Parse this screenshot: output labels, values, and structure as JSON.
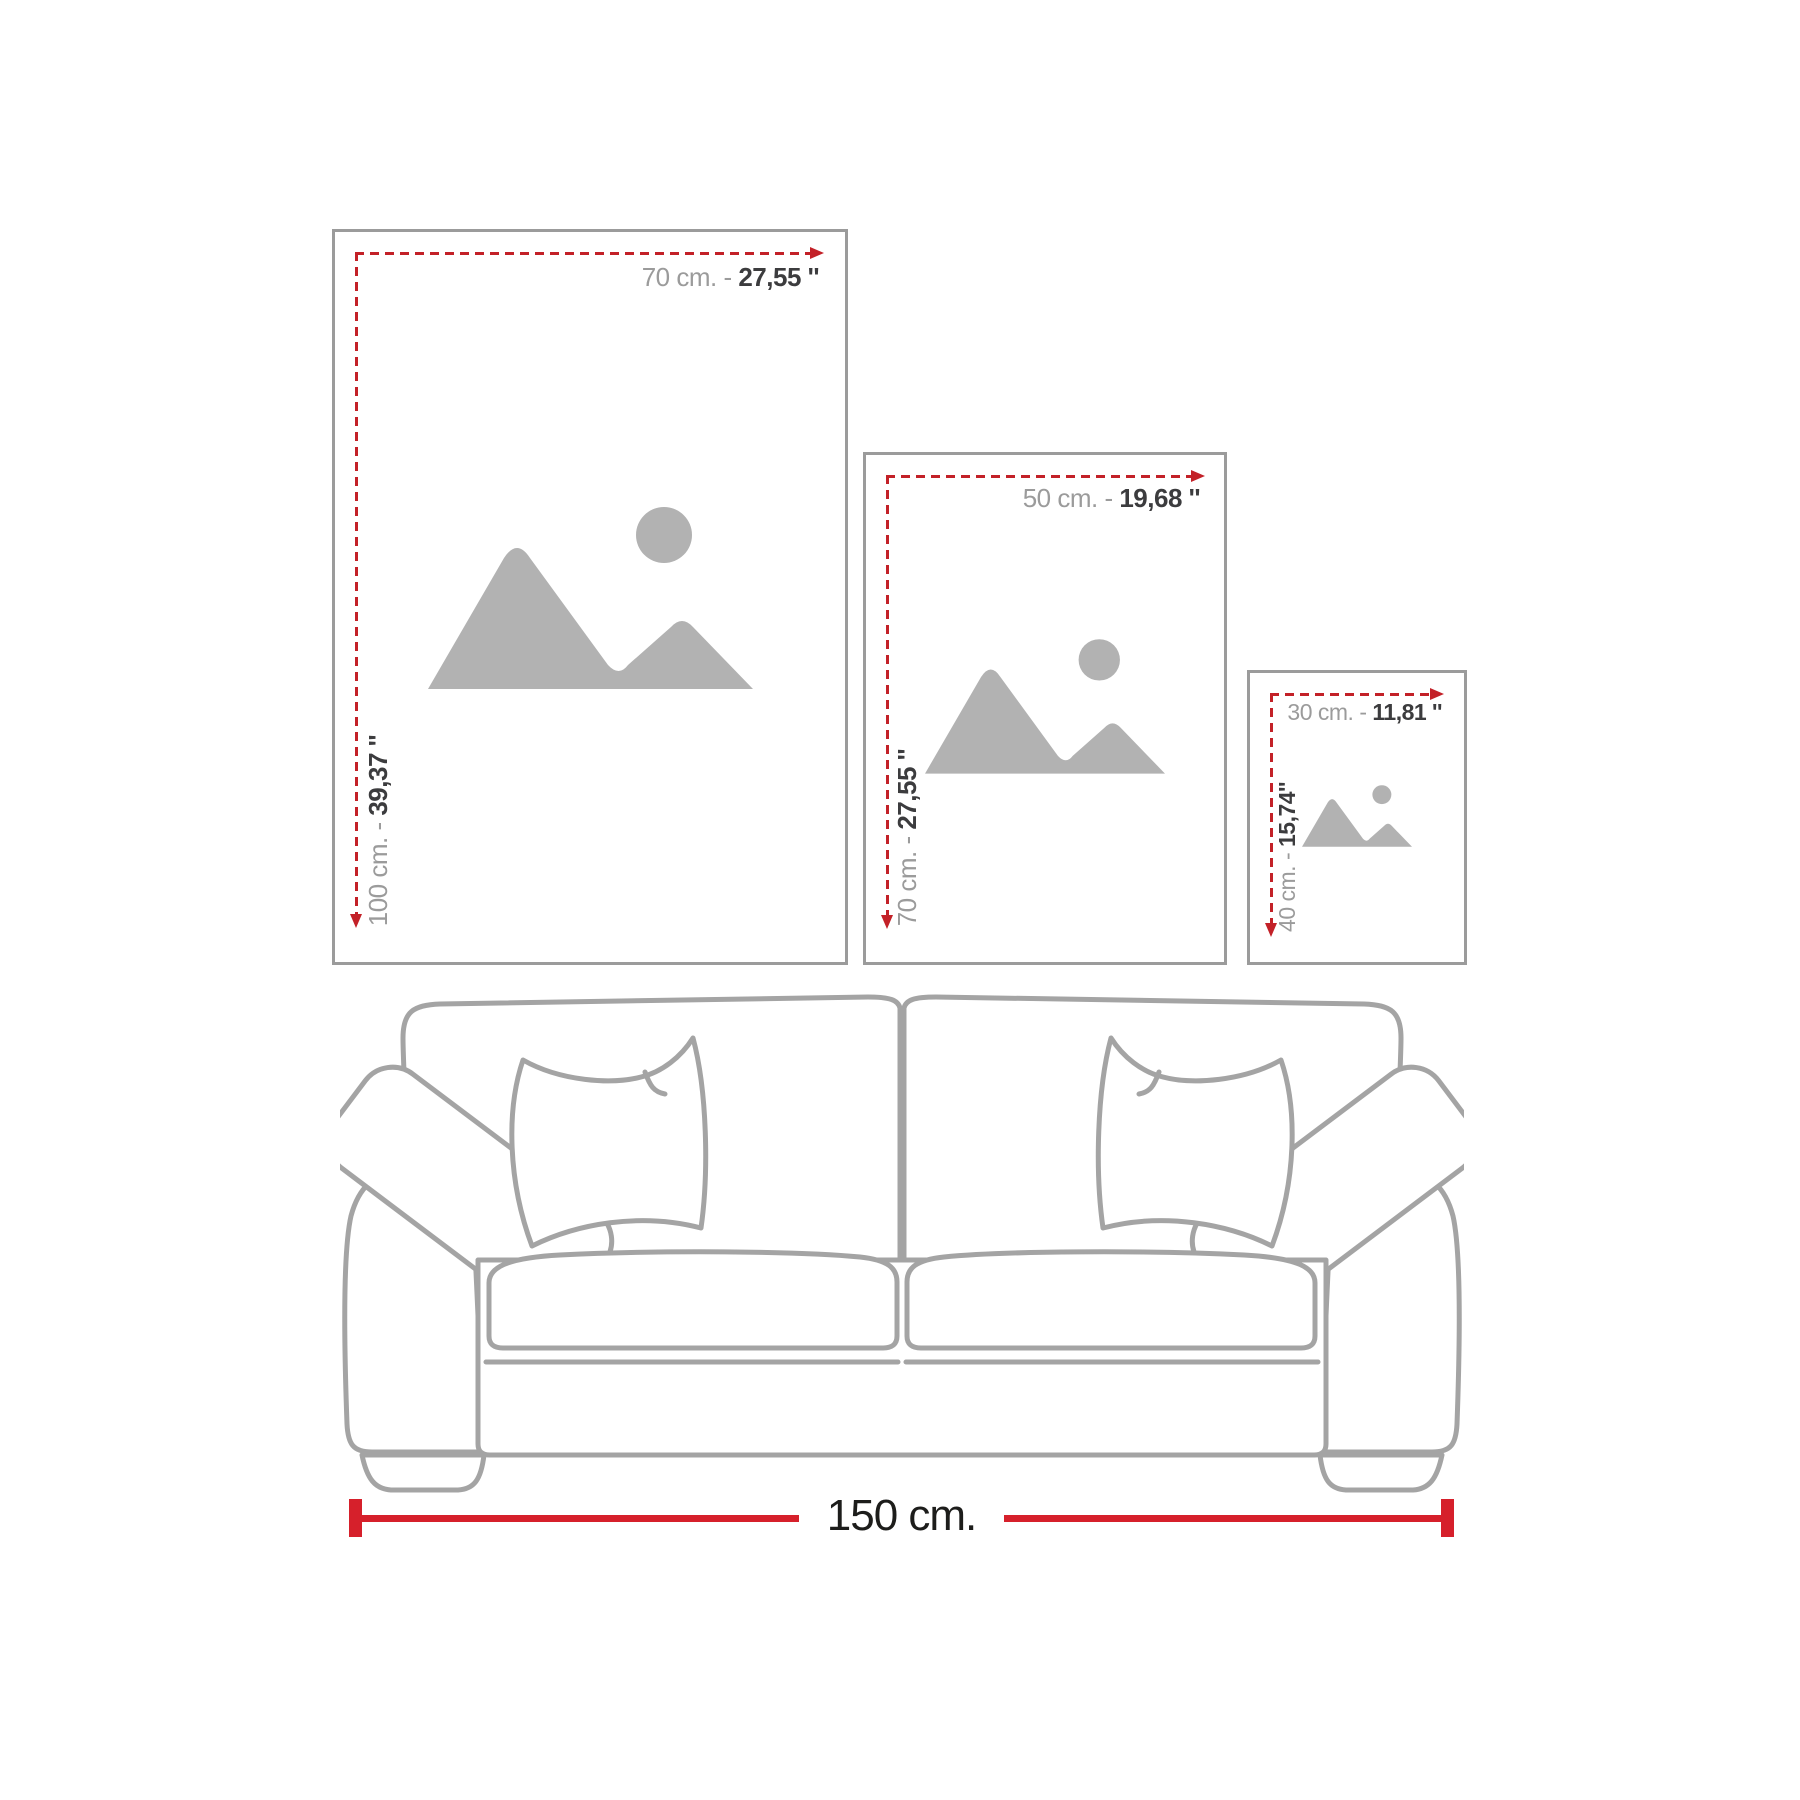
{
  "frames": [
    {
      "name": "large",
      "width_label": {
        "cm": "70 cm. - ",
        "inch": "27,55 ''"
      },
      "height_label": {
        "cm": "100 cm. - ",
        "inch": "39,37 ''"
      }
    },
    {
      "name": "medium",
      "width_label": {
        "cm": "50 cm. - ",
        "inch": "19,68 ''"
      },
      "height_label": {
        "cm": "70 cm. - ",
        "inch": "27,55 ''"
      }
    },
    {
      "name": "small",
      "width_label": {
        "cm": "30 cm. - ",
        "inch": "11,81 ''"
      },
      "height_label": {
        "cm": "40 cm. - ",
        "inch": "15,74''"
      }
    }
  ],
  "sofa": {
    "width_label": "150 cm."
  },
  "icons": {
    "placeholder": "image-placeholder-icon",
    "arrow_right": "arrow-right-icon",
    "arrow_down": "arrow-down-icon",
    "sofa": "sofa-line-art"
  },
  "colors": {
    "dash_red": "#c32128",
    "measure_red": "#d6202b",
    "gray_text": "#9b9b9b",
    "dark_text": "#3c3c3e",
    "frame_border": "#9b9b9b",
    "sofa_outline": "#a4a4a4",
    "placeholder_gray": "#b2b2b2",
    "bottom_label_color": "#1d1d1b"
  }
}
